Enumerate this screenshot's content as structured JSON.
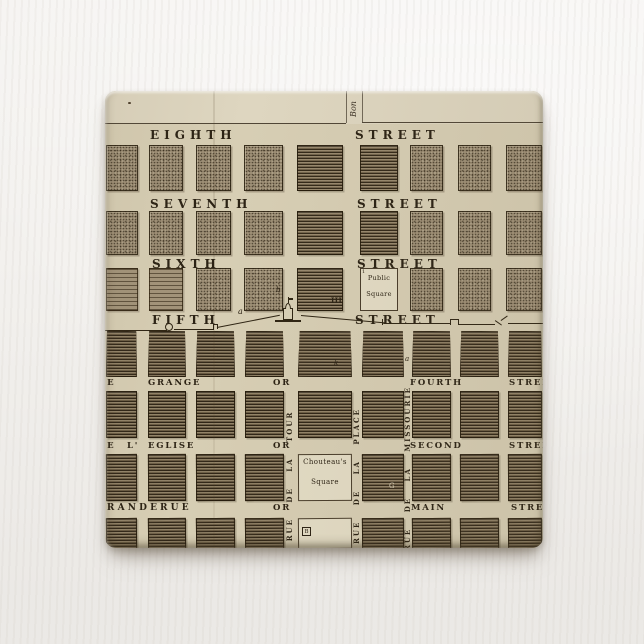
{
  "product": {
    "item": "square pinback button printed with an antique engraved city plan map",
    "background_color": "#f2f0ed",
    "map_paper_color": "#d7ceb4",
    "ink_color": "#2b2214",
    "block_stipple_color": "#9d8e75",
    "block_ruled_color": "#8b7b61",
    "square_fill_color": "#e3dcc5"
  },
  "map": {
    "edge_street_label": "Bon",
    "horizontal_streets": [
      {
        "name": "EIGHTH",
        "suffix": "STREET"
      },
      {
        "name": "SEVENTH",
        "suffix": "STREET"
      },
      {
        "name": "SIXTH",
        "suffix": "STREET"
      },
      {
        "name": "FIFTH",
        "suffix": "STREET"
      },
      {
        "fragment": "DE",
        "name": "GRANGE",
        "conj": "OR",
        "english": "FOURTH",
        "suffix": "STREET"
      },
      {
        "fragment": "DE",
        "fragment2": "L'",
        "name": "EGLISE",
        "conj": "OR",
        "english": "SECOND",
        "suffix": "STREET"
      },
      {
        "name": "GRANDE",
        "name2": "RUE",
        "conj": "OR",
        "english": "MAIN",
        "suffix": "STREET"
      }
    ],
    "vertical_streets": [
      "RUE DE LA TOUR",
      "RUE DE LA PLACE",
      "RUE DE LA MISSOURIE"
    ],
    "landmarks": {
      "public_square": {
        "marker": "1",
        "line1": "Public",
        "line2": "Square"
      },
      "chouteau_square": {
        "line1": "Chouteau's",
        "line2": "Square"
      }
    },
    "annotations": {
      "a": "a",
      "b": "b",
      "ticks": "III",
      "k": "k",
      "a2": "a",
      "g": "G",
      "boxed_b": "B"
    }
  }
}
